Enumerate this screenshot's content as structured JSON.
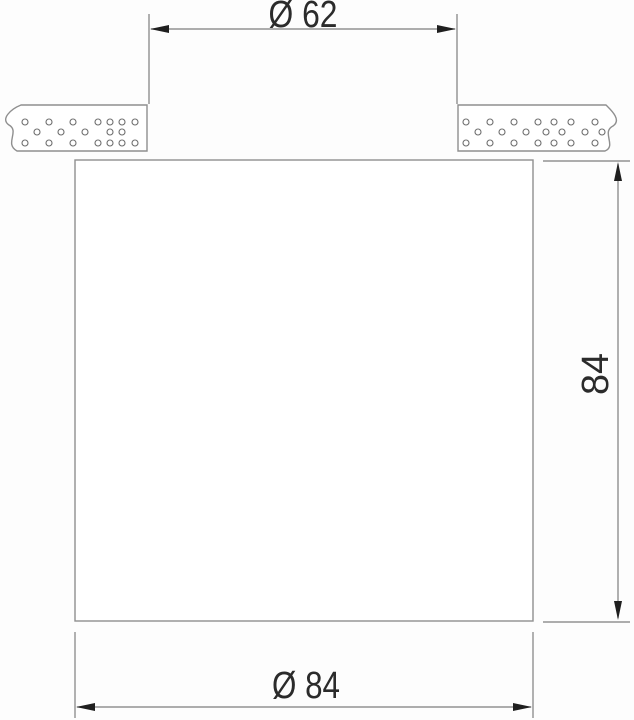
{
  "drawing": {
    "colors": {
      "line": "#8f8f8f",
      "dim_line": "#7e7e7e",
      "arrow": "#1f1f1f",
      "text": "#2b2b2b",
      "fill": "#ffffff",
      "background": "#fdfdfd",
      "hatch_dot": "#6e6e6e"
    },
    "dimensions": {
      "cutout_diameter": {
        "label": "Ø 62"
      },
      "height": {
        "label": "84"
      },
      "body_diameter": {
        "label": "Ø 84"
      }
    },
    "hatch": {
      "dot_radius": 3,
      "left_panel_dots": [
        [
          25,
          122
        ],
        [
          49,
          122
        ],
        [
          73,
          122
        ],
        [
          98,
          122
        ],
        [
          110,
          122
        ],
        [
          122,
          122
        ],
        [
          135,
          122
        ],
        [
          37,
          132
        ],
        [
          61,
          132
        ],
        [
          85,
          132
        ],
        [
          110,
          132
        ],
        [
          122,
          132
        ],
        [
          25,
          143
        ],
        [
          49,
          143
        ],
        [
          73,
          143
        ],
        [
          98,
          143
        ],
        [
          110,
          143
        ],
        [
          122,
          143
        ],
        [
          135,
          143
        ]
      ],
      "right_panel_dots": [
        [
          466,
          122
        ],
        [
          490,
          122
        ],
        [
          514,
          122
        ],
        [
          538,
          122
        ],
        [
          554,
          122
        ],
        [
          571,
          122
        ],
        [
          595,
          122
        ],
        [
          478,
          132
        ],
        [
          502,
          132
        ],
        [
          526,
          132
        ],
        [
          546,
          132
        ],
        [
          562,
          132
        ],
        [
          585,
          132
        ],
        [
          602,
          132
        ],
        [
          466,
          143
        ],
        [
          490,
          143
        ],
        [
          514,
          143
        ],
        [
          538,
          143
        ],
        [
          554,
          143
        ],
        [
          571,
          143
        ],
        [
          595,
          143
        ]
      ]
    }
  }
}
